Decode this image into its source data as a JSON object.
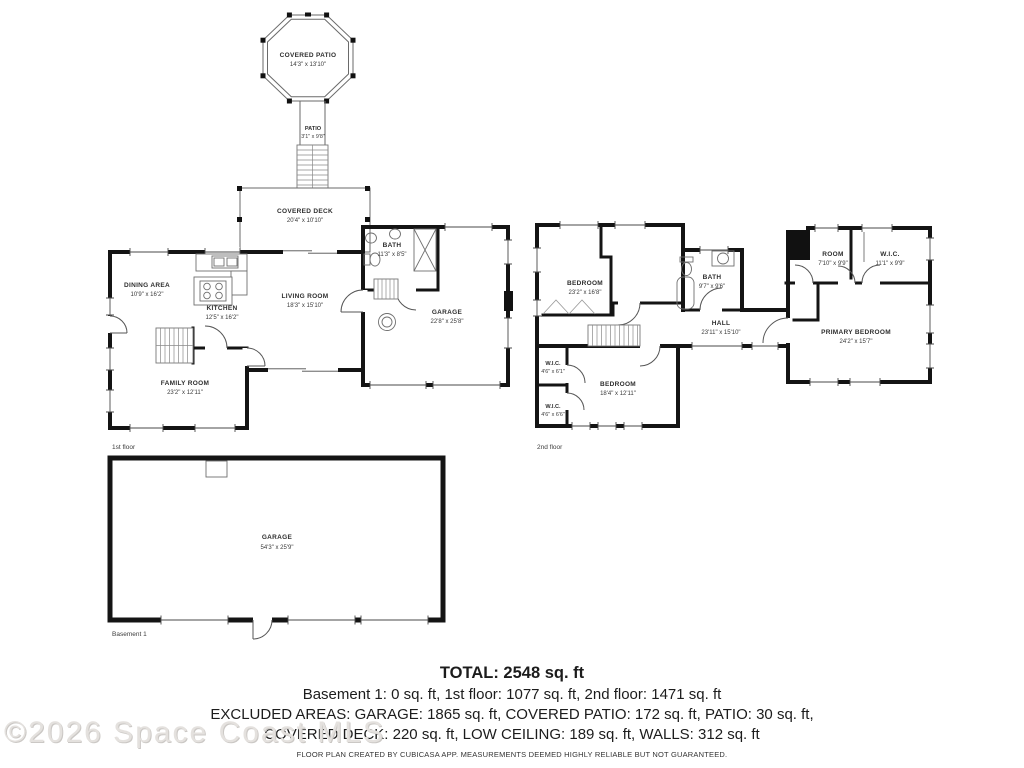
{
  "watermark": "©2026 Space Coast MLS",
  "floor_labels": {
    "first": "1st floor",
    "second": "2nd floor",
    "basement": "Basement 1"
  },
  "rooms": {
    "covered_patio": {
      "name": "COVERED PATIO",
      "dims": "14'3\" x 13'10\""
    },
    "patio": {
      "name": "PATIO",
      "dims": "3'1\" x 9'8\""
    },
    "covered_deck": {
      "name": "COVERED DECK",
      "dims": "20'4\" x 10'10\""
    },
    "dining_area": {
      "name": "DINING AREA",
      "dims": "10'9\" x 16'2\""
    },
    "kitchen": {
      "name": "KITCHEN",
      "dims": "12'5\" x 16'2\""
    },
    "living_room": {
      "name": "LIVING ROOM",
      "dims": "18'3\" x 15'10\""
    },
    "bath_1f": {
      "name": "BATH",
      "dims": "11'3\" x 8'5\""
    },
    "garage_1f": {
      "name": "GARAGE",
      "dims": "22'8\" x 25'8\""
    },
    "family_room": {
      "name": "FAMILY ROOM",
      "dims": "23'2\" x 12'11\""
    },
    "bedroom_large_2f": {
      "name": "BEDROOM",
      "dims": "23'2\" x 16'8\""
    },
    "bath_2f": {
      "name": "BATH",
      "dims": "9'7\" x 9'6\""
    },
    "hall_2f": {
      "name": "HALL",
      "dims": "23'11\" x 15'10\""
    },
    "room_2f": {
      "name": "ROOM",
      "dims": "7'10\" x 9'9\""
    },
    "wic_right_2f": {
      "name": "W.I.C.",
      "dims": "11'1\" x 9'9\""
    },
    "primary_bedroom": {
      "name": "PRIMARY BEDROOM",
      "dims": "24'2\" x 15'7\""
    },
    "wic_upper_2f": {
      "name": "W.I.C.",
      "dims": "4'6\" x 6'1\""
    },
    "bedroom_2f": {
      "name": "BEDROOM",
      "dims": "18'4\" x 12'11\""
    },
    "wic_lower_2f": {
      "name": "W.I.C.",
      "dims": "4'6\" x 6'6\""
    },
    "garage_basement": {
      "name": "GARAGE",
      "dims": "54'3\" x 25'9\""
    }
  },
  "summary": {
    "total": "TOTAL: 2548 sq. ft",
    "floors_line": "Basement 1: 0 sq. ft, 1st floor: 1077 sq. ft, 2nd floor: 1471 sq. ft",
    "excluded_line1": "EXCLUDED AREAS: GARAGE: 1865 sq. ft, COVERED PATIO: 172 sq. ft, PATIO: 30 sq. ft,",
    "excluded_line2": "COVERED DECK: 220 sq. ft, LOW CEILING: 189 sq. ft, WALLS: 312 sq. ft",
    "disclaimer": "FLOOR PLAN CREATED BY CUBICASA APP. MEASUREMENTS DEEMED HIGHLY RELIABLE BUT NOT GUARANTEED."
  }
}
